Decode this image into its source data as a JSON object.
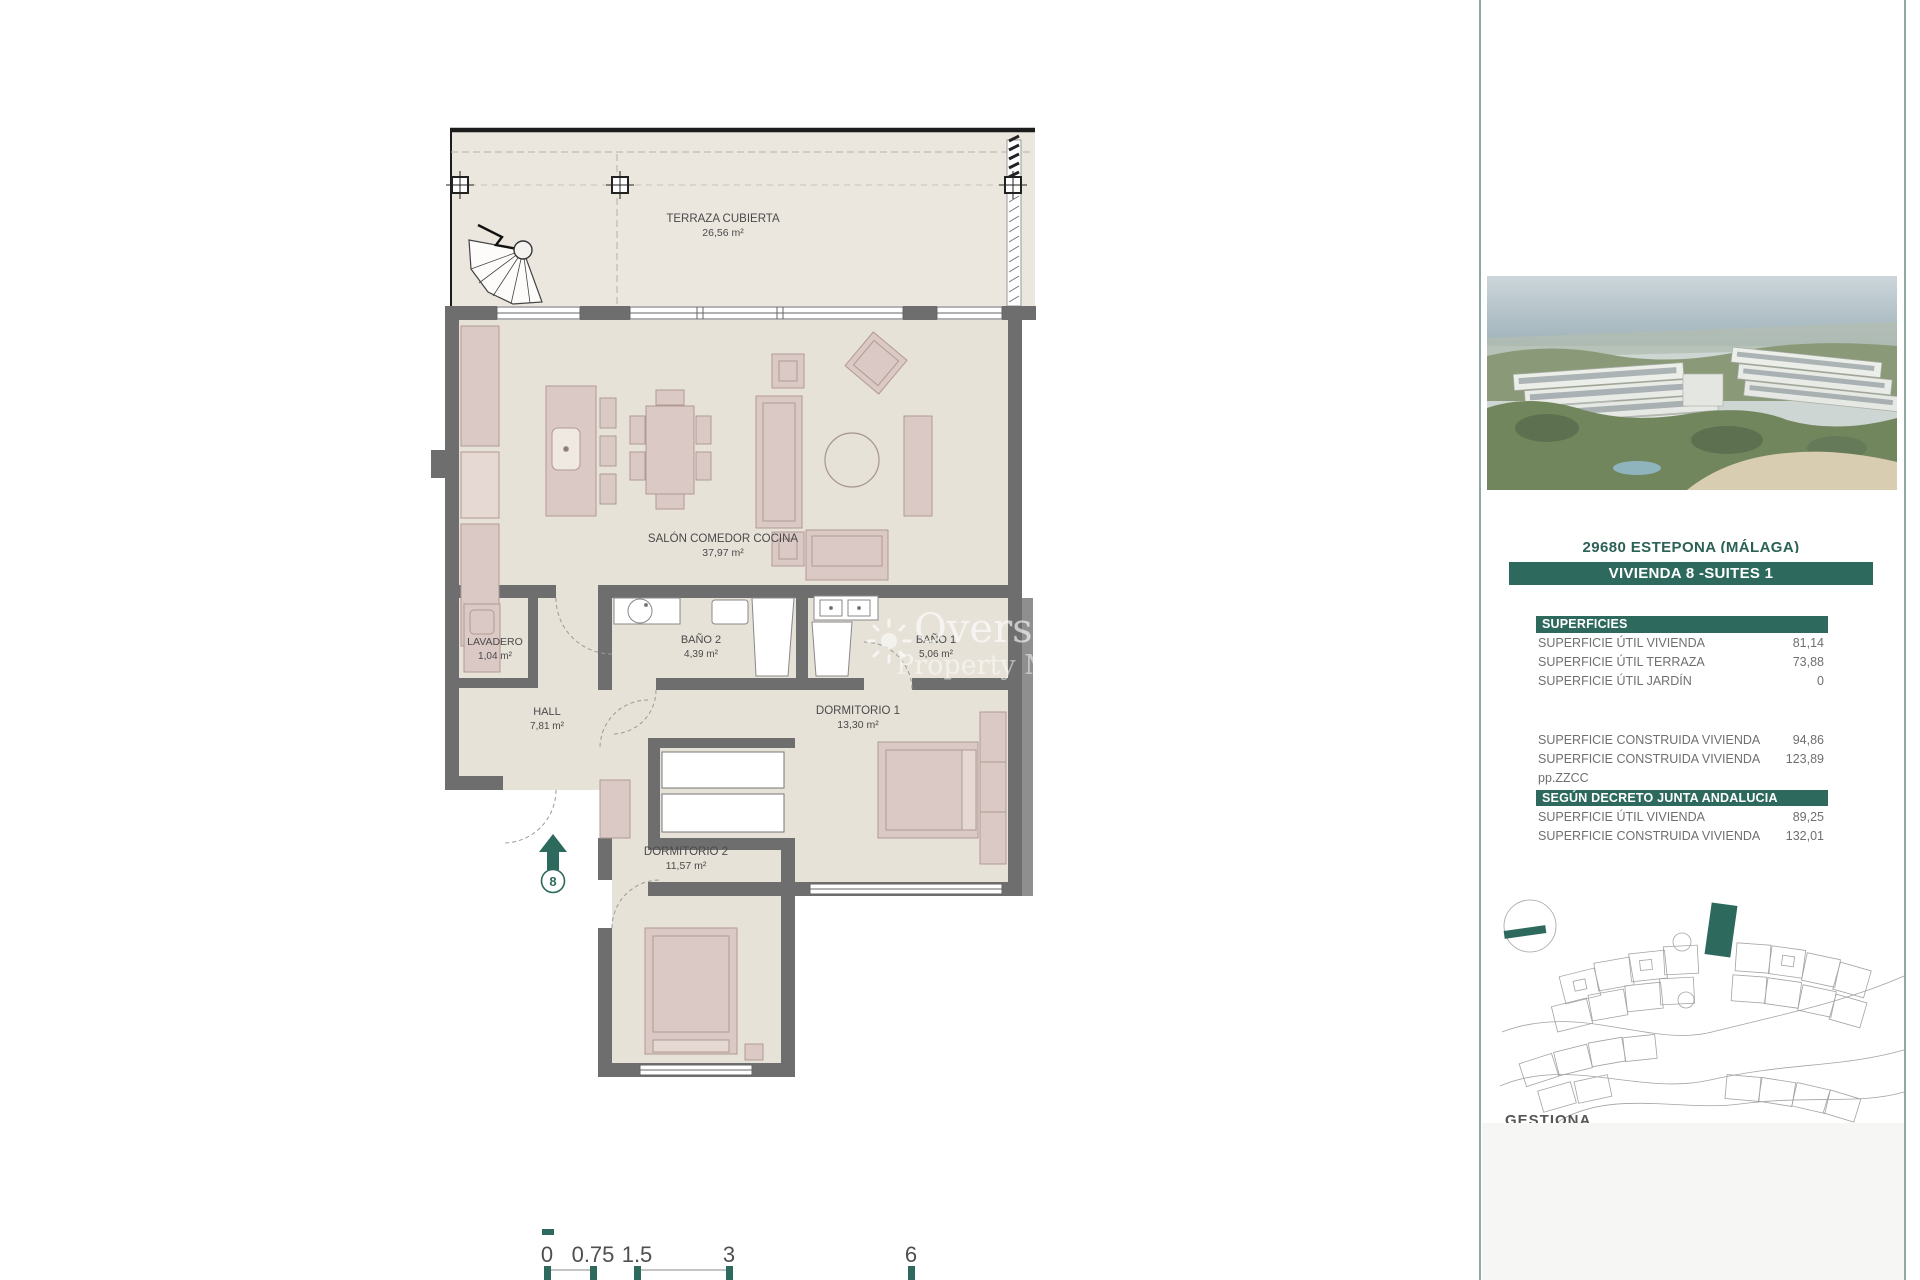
{
  "colors": {
    "accent_green": "#2d6a5d",
    "wall_gray": "#6e6e6e",
    "floor_fill": "#e7e2d8",
    "terrace_fill": "#ebe7df",
    "furniture_pink": "#dbc9c5"
  },
  "plan": {
    "rooms": [
      {
        "id": "terraza",
        "name": "TERRAZA CUBIERTA",
        "area": "26,56 m²"
      },
      {
        "id": "salon",
        "name": "SALÓN COMEDOR COCINA",
        "area": "37,97 m²"
      },
      {
        "id": "lavadero",
        "name": "LAVADERO",
        "area": "1,04 m²"
      },
      {
        "id": "bano2",
        "name": "BAÑO 2",
        "area": "4,39 m²"
      },
      {
        "id": "bano1",
        "name": "BAÑO 1",
        "area": "5,06 m²"
      },
      {
        "id": "hall",
        "name": "HALL",
        "area": "7,81 m²"
      },
      {
        "id": "dormitorio1",
        "name": "DORMITORIO 1",
        "area": "13,30 m²"
      },
      {
        "id": "dormitorio2",
        "name": "DORMITORIO 2",
        "area": "11,57 m²"
      }
    ],
    "entrance_label": "8",
    "scale_labels": [
      "0",
      "0.75",
      "1.5",
      "3",
      "6"
    ],
    "watermark": {
      "line1": "Overseas",
      "line2": "Property Market"
    }
  },
  "sidebar": {
    "location_line": "29680 ESTEPONA (MÁLAGA)",
    "unit_title": "VIVIENDA 8 -SUITES 1",
    "superficies": {
      "header": "SUPERFICIES",
      "rows": [
        {
          "label": "SUPERFICIE ÚTIL VIVIENDA",
          "value": "81,14"
        },
        {
          "label": "SUPERFICIE ÚTIL TERRAZA",
          "value": "73,88"
        },
        {
          "label": "SUPERFICIE ÚTIL JARDÍN",
          "value": "0"
        },
        {
          "label": "SUPERFICIE CONSTRUIDA VIVIENDA",
          "value": "94,86"
        },
        {
          "label": "SUPERFICIE CONSTRUIDA VIVIENDA pp.ZZCC",
          "value": "123,89"
        }
      ]
    },
    "decreto": {
      "header": "SEGÚN DECRETO JUNTA ANDALUCIA",
      "rows": [
        {
          "label": "SUPERFICIE ÚTIL VIVIENDA",
          "value": "89,25"
        },
        {
          "label": "SUPERFICIE CONSTRUIDA VIVIENDA",
          "value": "132,01"
        }
      ]
    },
    "footer_partial": "GESTIONA"
  }
}
